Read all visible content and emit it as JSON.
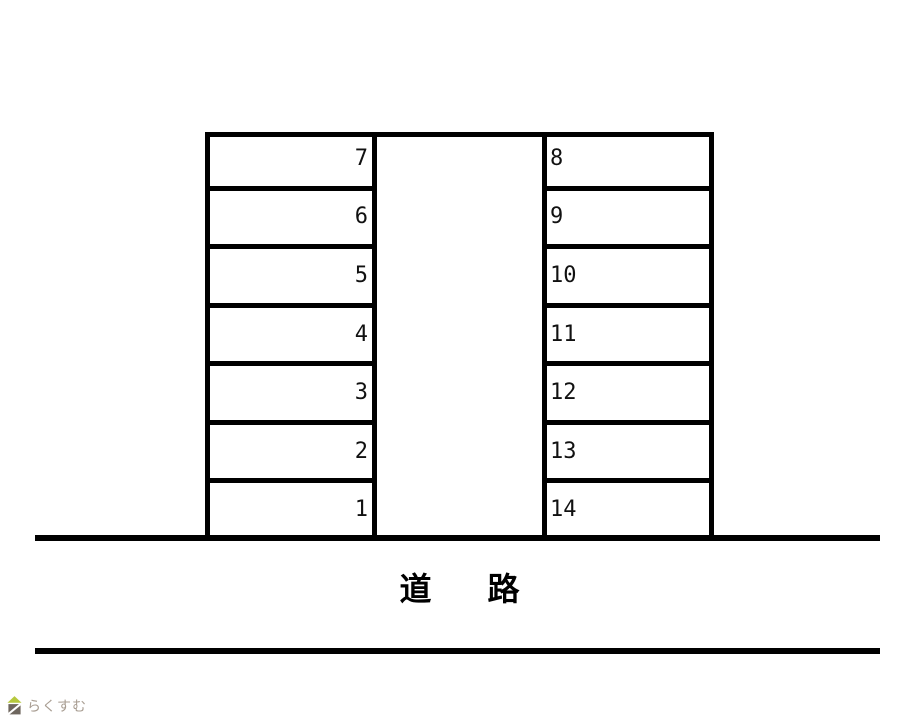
{
  "diagram": {
    "type": "parking-lot-map",
    "line_color": "#000000",
    "left_column": {
      "spaces_top_to_bottom": [
        "7",
        "6",
        "5",
        "4",
        "3",
        "2",
        "1"
      ]
    },
    "right_column": {
      "spaces_top_to_bottom": [
        "8",
        "9",
        "10",
        "11",
        "12",
        "13",
        "14"
      ]
    },
    "total_spaces": 14
  },
  "road": {
    "label": "道　路"
  },
  "logo": {
    "text": "らくすむ",
    "text_color": "#a89d92",
    "roof_color": "#b6c83d",
    "body_color": "#6e665e",
    "slash_color": "#ffffff"
  }
}
